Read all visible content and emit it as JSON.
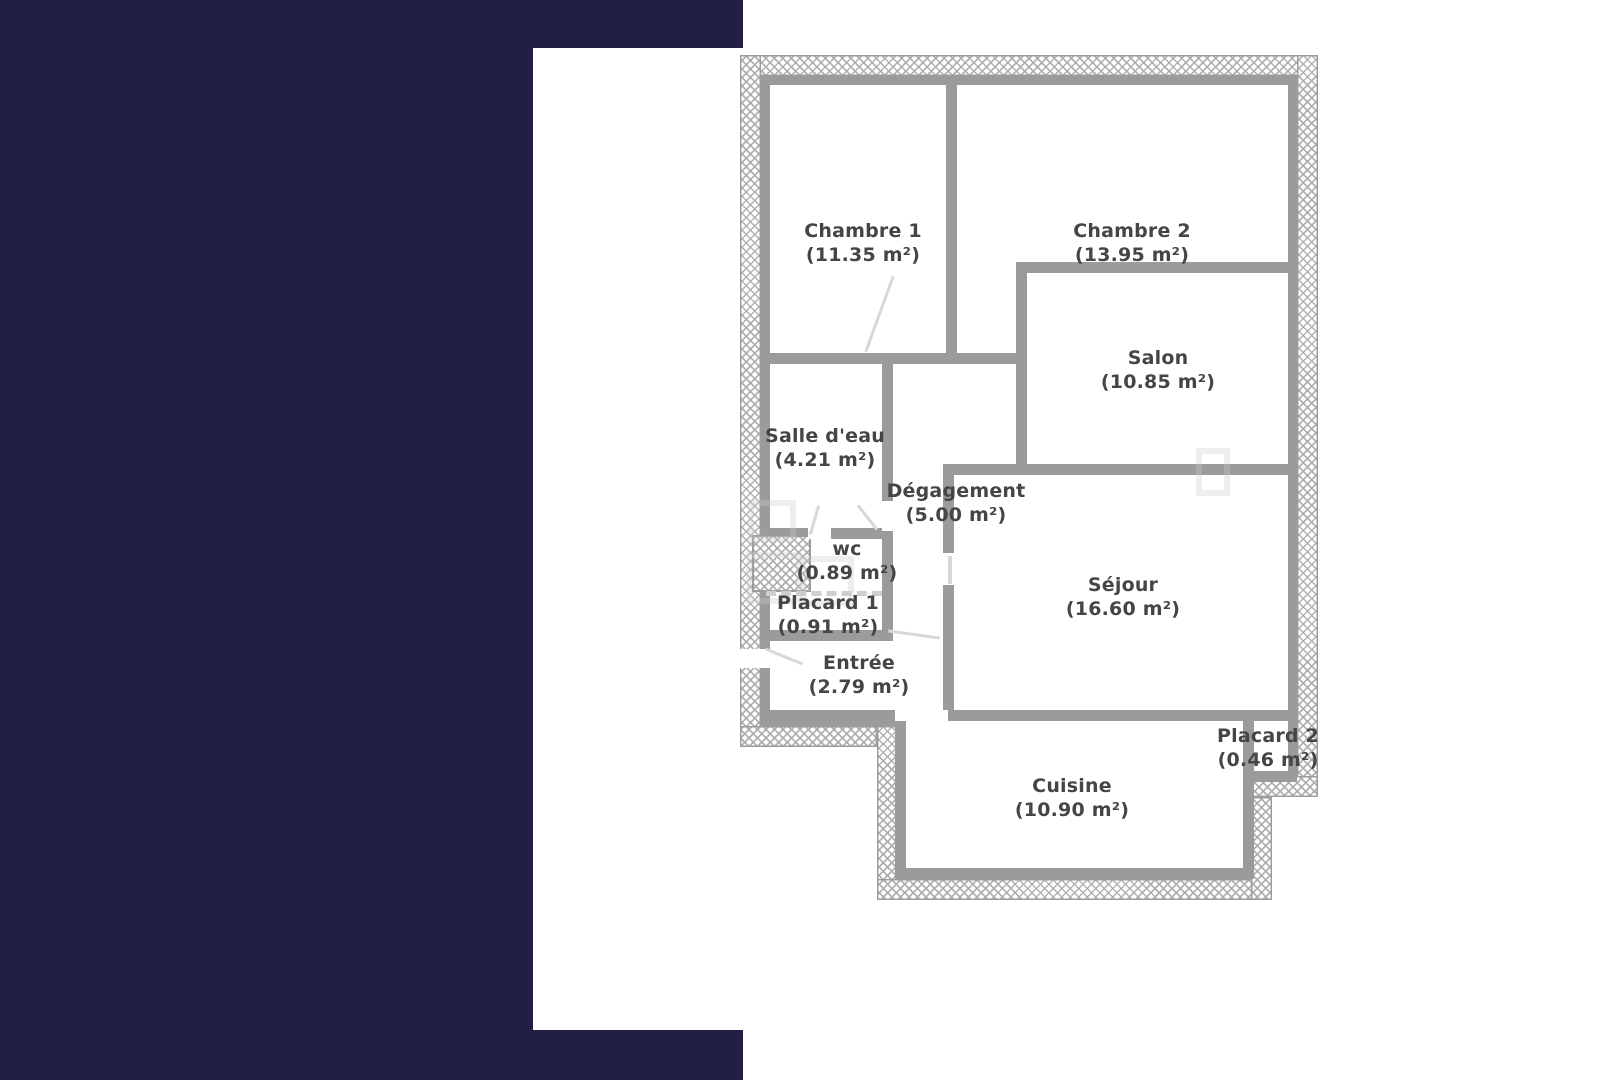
{
  "palette": {
    "frame_navy": "#221f44",
    "wall_gray": "#9b9b9b",
    "hatch_gray": "#aaaaaa",
    "label_text": "#454545"
  },
  "floor_plan": {
    "units": "m²",
    "rooms": [
      {
        "id": "chambre1",
        "name": "Chambre 1",
        "area": "(11.35 m²)"
      },
      {
        "id": "chambre2",
        "name": "Chambre 2",
        "area": "(13.95 m²)"
      },
      {
        "id": "salon",
        "name": "Salon",
        "area": "(10.85 m²)"
      },
      {
        "id": "salle_eau",
        "name": "Salle d'eau",
        "area": "(4.21 m²)"
      },
      {
        "id": "degagement",
        "name": "Dégagement",
        "area": "(5.00 m²)"
      },
      {
        "id": "wc",
        "name": "wc",
        "area": "(0.89 m²)"
      },
      {
        "id": "placard1",
        "name": "Placard 1",
        "area": "(0.91 m²)"
      },
      {
        "id": "entree",
        "name": "Entrée",
        "area": "(2.79 m²)"
      },
      {
        "id": "sejour",
        "name": "Séjour",
        "area": "(16.60 m²)"
      },
      {
        "id": "cuisine",
        "name": "Cuisine",
        "area": "(10.90 m²)"
      },
      {
        "id": "placard2",
        "name": "Placard 2",
        "area": "(0.46 m²)"
      }
    ]
  }
}
